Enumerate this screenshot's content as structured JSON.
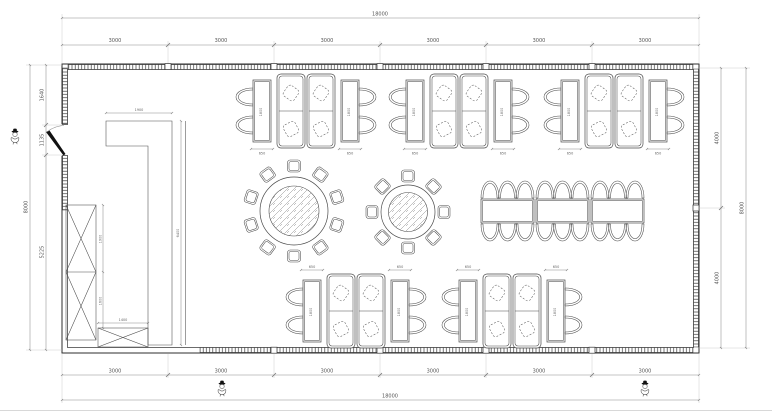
{
  "dimensions": {
    "top": {
      "overall": "18000",
      "segments": [
        "3000",
        "3000",
        "3000",
        "3000",
        "3000",
        "3000"
      ]
    },
    "bottom": {
      "overall": "18000",
      "segments": [
        "3000",
        "3000",
        "3000",
        "3000",
        "3000",
        "3000"
      ]
    },
    "left": {
      "overall": "8000",
      "segments": [
        "1640",
        "1135",
        "5225"
      ]
    },
    "right": {
      "overall": "8000",
      "segments": [
        "4000",
        "4000"
      ]
    },
    "interior": {
      "counter_width": "1900",
      "counter_length": "6400",
      "cabinet_upper": "1900",
      "cabinet_lower": "1600",
      "cabinet_box": "1400",
      "booth_table_width": "650",
      "booth_table_length": "1800"
    }
  }
}
